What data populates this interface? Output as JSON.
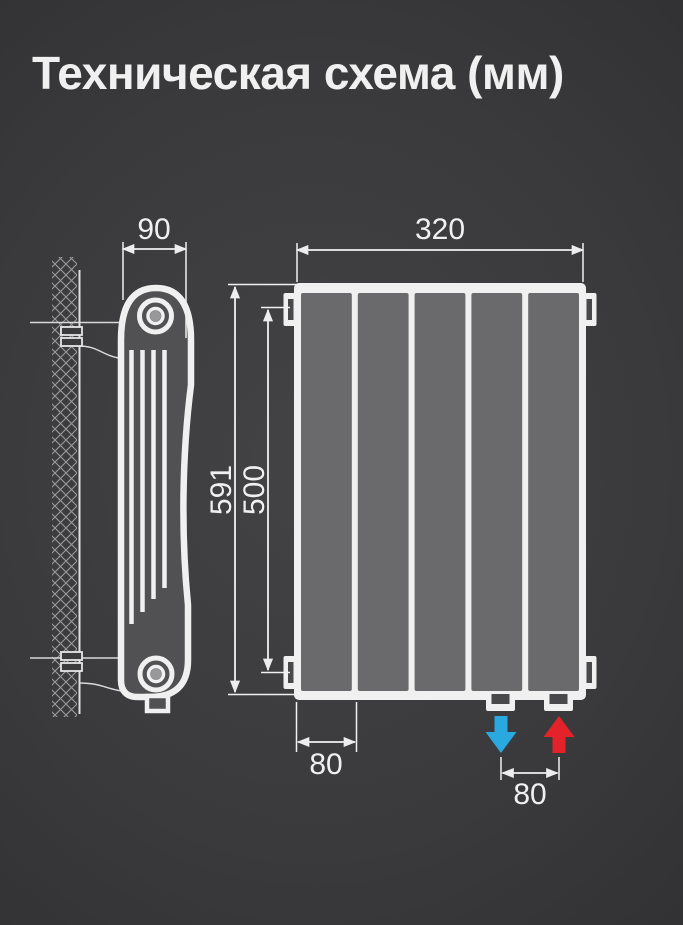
{
  "title": "Техническая схема (мм)",
  "dimensions": {
    "side_depth": "90",
    "front_width": "320",
    "overall_height": "591",
    "axis_spacing": "500",
    "section_pitch": "80",
    "pipe_spacing": "80"
  },
  "section_count": 5,
  "colors": {
    "background": "#3b3b3d",
    "line": "#f0f0f0",
    "panel": "#6a6a6c",
    "body": "#515153",
    "slot": "#49494b",
    "hub_center": "#98989b",
    "flow_cold": "#2aa9e0",
    "flow_hot": "#e3222a"
  }
}
